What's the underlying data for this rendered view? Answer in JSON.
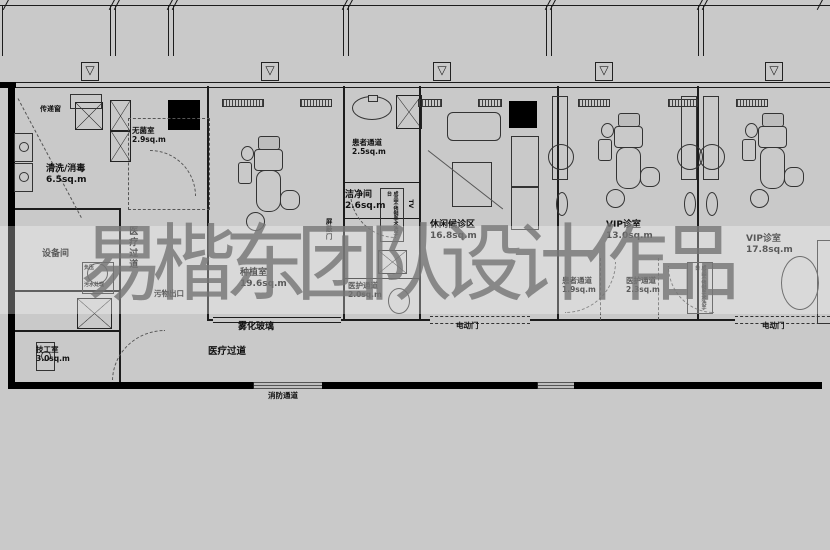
{
  "watermark": {
    "text": "易楷东团队设计作品"
  },
  "icons": {
    "vent": "▽"
  },
  "rooms": {
    "cleaning": {
      "name": "清洗/消毒",
      "area": "6.5sq.m"
    },
    "sterile": {
      "name": "无菌室",
      "area": "2.9sq.m"
    },
    "equipment": {
      "name": "设备间"
    },
    "technician": {
      "name": "技工室",
      "area": "3.0sq.m"
    },
    "implant": {
      "name": "种植室",
      "area": "19.6sq.m"
    },
    "patient_corridor_1": {
      "name": "患者通道",
      "area": "2.5sq.m"
    },
    "clean_room": {
      "name": "洁净间",
      "area": "2.6sq.m"
    },
    "waiting": {
      "name": "休闲候诊区",
      "area": "16.8sq.m"
    },
    "staff_corridor_1": {
      "name": "医护通道",
      "area": "2.0sq.m"
    },
    "vip_1": {
      "name": "VIP诊室",
      "area": "13.0sq.m"
    },
    "patient_corridor_2": {
      "name": "患者通道",
      "area": "1.9sq.m"
    },
    "staff_corridor_2": {
      "name": "医护通道",
      "area": "2.3sq.m"
    },
    "vip_2": {
      "name": "VIP诊室",
      "area": "17.8sq.m"
    }
  },
  "labels": {
    "pass_window": "传递窗",
    "waste_exit": "污物出口",
    "fog_glass": "雾化玻璃",
    "medical_corridor": "医疗过道",
    "medical_corridor_vertical": "医疗过道",
    "fire_exit": "消防通道",
    "electric_door_1": "电动门",
    "electric_door_2": "电动门",
    "shield_door": "屏蔽门",
    "tv": "TV",
    "sewage_line1": "负压",
    "sewage_line2": "污水处理",
    "stainless_1": "成品不锈钢手术洗手台",
    "stainless_2": "成品不锈钢手术洗手台"
  },
  "colors": {
    "background": "#c9c9c9",
    "line": "#1c1c1c",
    "wall_fill": "#000000",
    "watermark_gray": "#757575"
  }
}
